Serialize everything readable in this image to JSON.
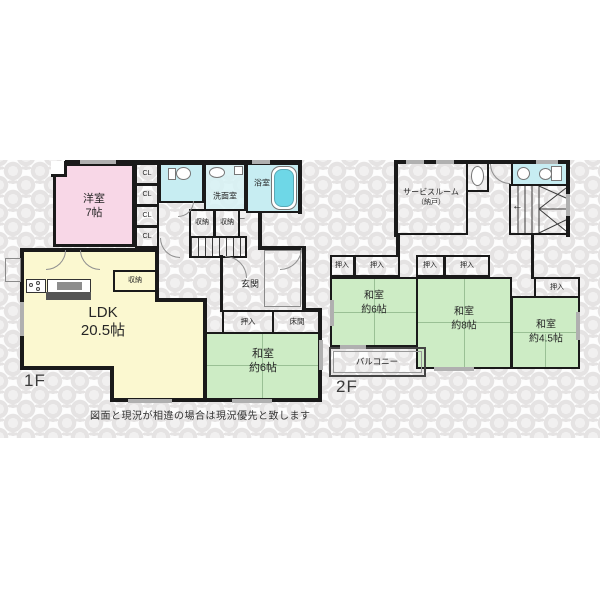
{
  "floor1": {
    "label": "1F",
    "yoshitsu_name": "洋室",
    "yoshitsu_size": "7帖",
    "cl": "CL",
    "senmen": "洗面室",
    "bath": "浴室",
    "shuno": "収納",
    "genkan": "玄関",
    "ldk_name": "LDK",
    "ldk_size": "20.5帖",
    "oshiire": "押入",
    "tokonoma": "床間",
    "washitsu_name": "和室",
    "washitsu_size": "約6帖"
  },
  "floor2": {
    "label": "2F",
    "service_line1": "サービスルーム",
    "service_line2": "（納戸）",
    "oshiire": "押入",
    "w6_name": "和室",
    "w6_size": "約6帖",
    "w8_name": "和室",
    "w8_size": "約8帖",
    "w45_name": "和室",
    "w45_size": "約4.5帖",
    "balcony": "バルコニー"
  },
  "icons": {
    "stairs_arrow": "←"
  },
  "footer": {
    "disclaimer": "図面と現況が相違の場合は現況優先と致します"
  },
  "colors": {
    "wall": "#1a1a1a",
    "pink": "#f8d7e7",
    "yellow": "#fbf8d0",
    "green": "#cdecc5",
    "cyan1": "#c7edf2",
    "cyan2": "#d7f2f5",
    "tub": "#6ed7e7",
    "win": "#b0b0b0",
    "pat": "#e5e3e3"
  }
}
